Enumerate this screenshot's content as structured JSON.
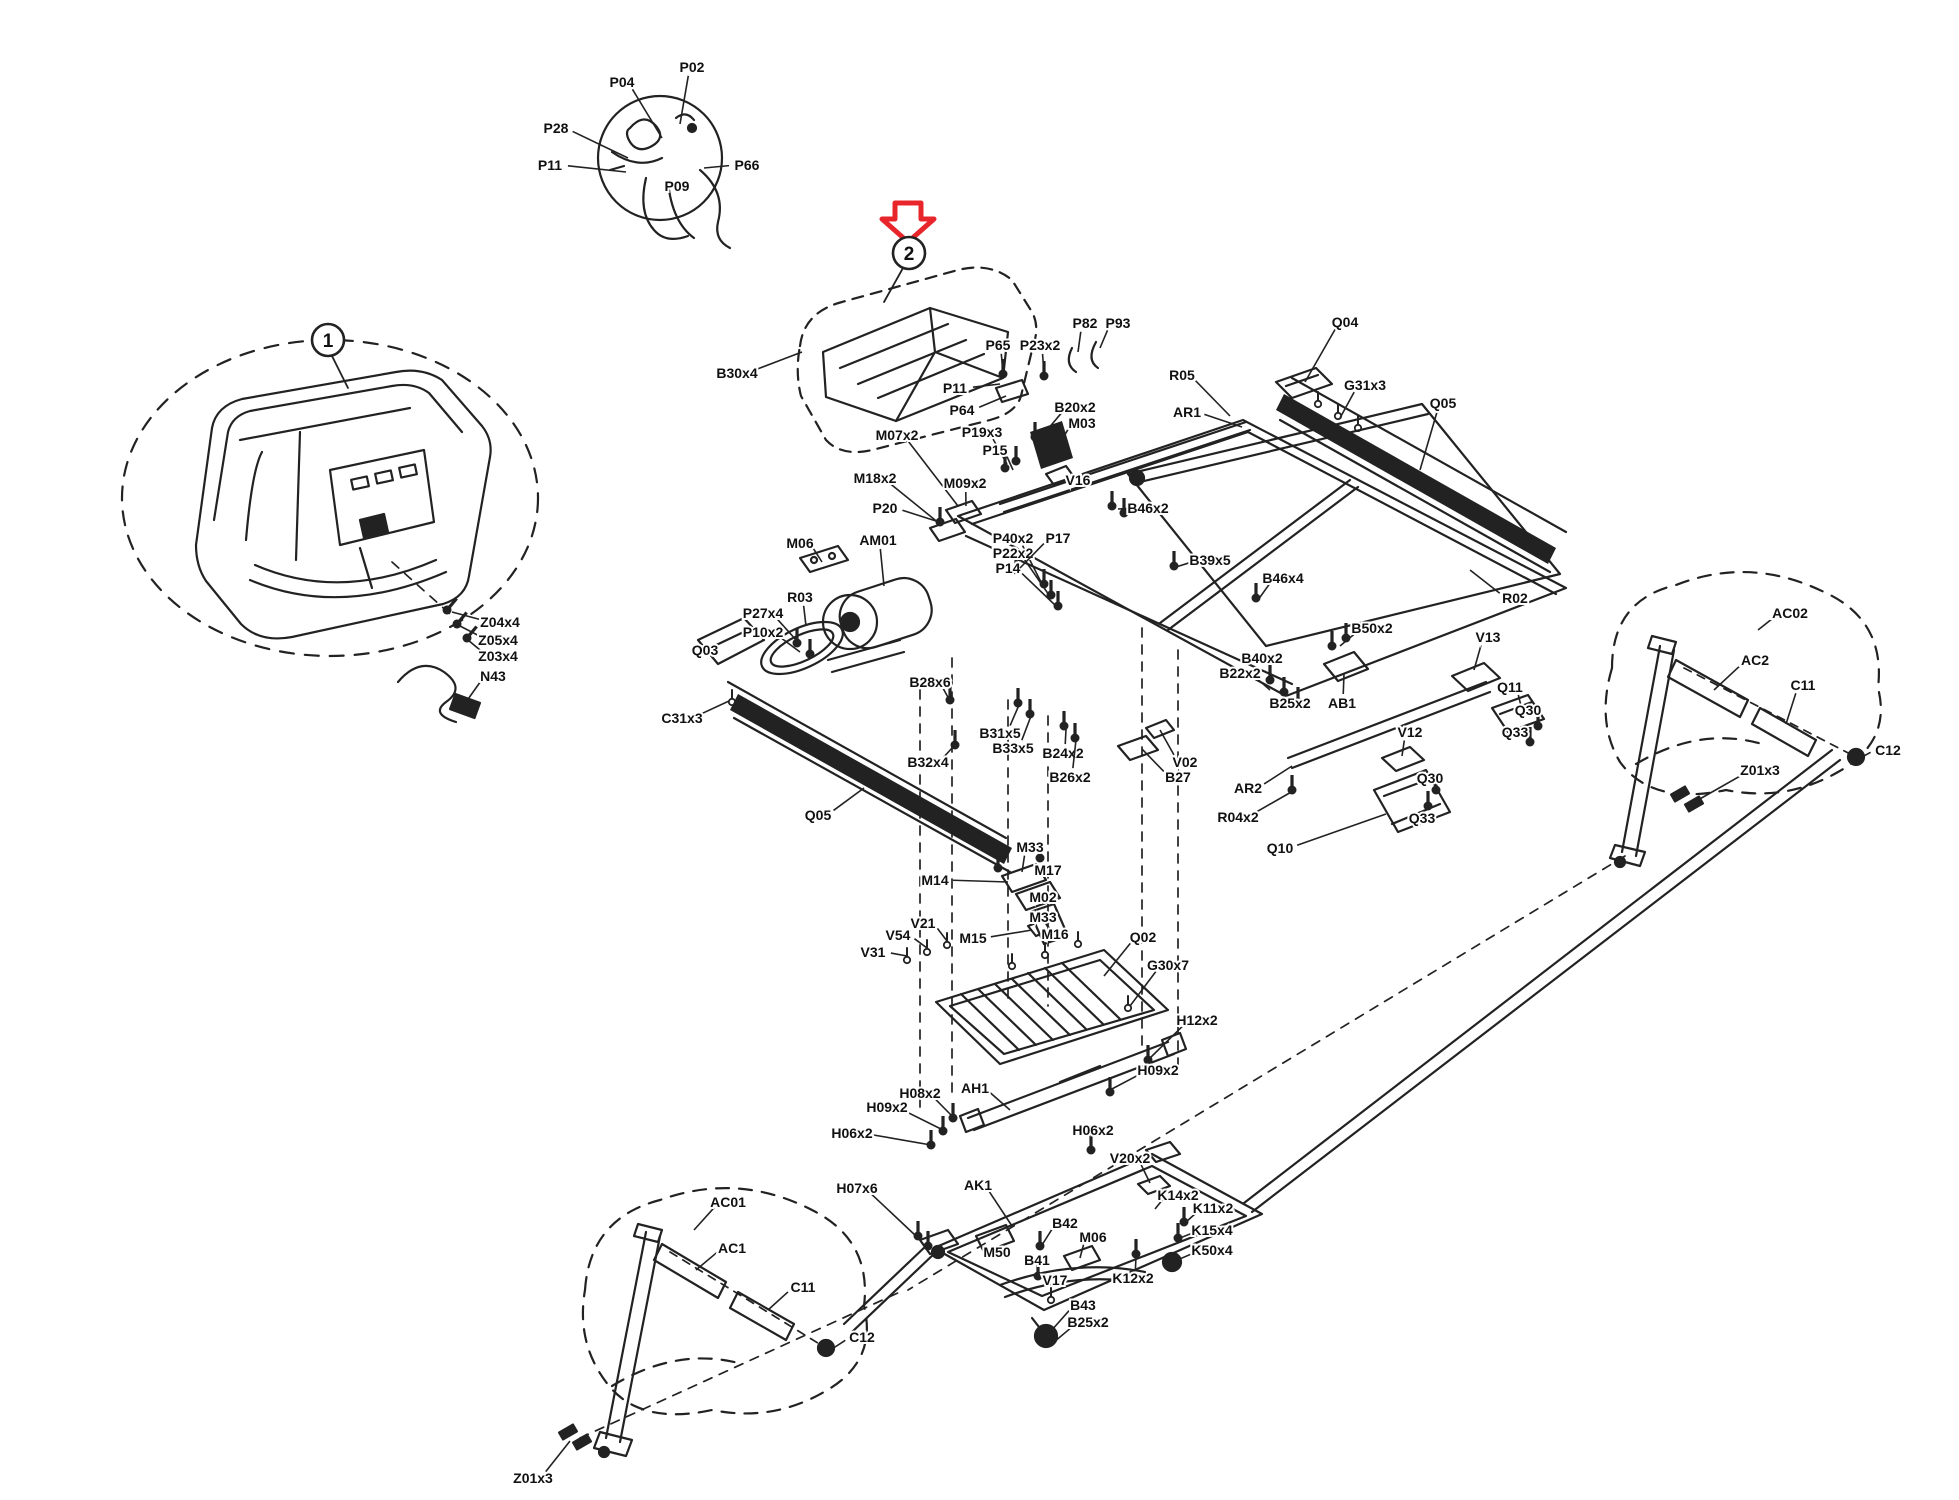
{
  "diagram": {
    "type": "exploded-parts-diagram",
    "arrow_color": "#e8252a",
    "line_color": "#222222",
    "callouts": [
      {
        "n": "1",
        "x": 328,
        "y": 340
      },
      {
        "n": "2",
        "x": 909,
        "y": 253
      }
    ],
    "labels": [
      {
        "t": "P04",
        "x": 622,
        "y": 82,
        "tx": 662,
        "ty": 138
      },
      {
        "t": "P02",
        "x": 692,
        "y": 67,
        "tx": 680,
        "ty": 124
      },
      {
        "t": "P28",
        "x": 556,
        "y": 128,
        "tx": 628,
        "ty": 158
      },
      {
        "t": "P11",
        "x": 550,
        "y": 165,
        "tx": 626,
        "ty": 172
      },
      {
        "t": "P66",
        "x": 747,
        "y": 165,
        "tx": 704,
        "ty": 168
      },
      {
        "t": "P09",
        "x": 677,
        "y": 186,
        "tx": 668,
        "ty": 170
      },
      {
        "t": "B30x4",
        "x": 737,
        "y": 373,
        "tx": 802,
        "ty": 352
      },
      {
        "t": "P65",
        "x": 998,
        "y": 345,
        "tx": 1003,
        "ty": 372
      },
      {
        "t": "P23x2",
        "x": 1040,
        "y": 345,
        "tx": 1044,
        "ty": 373
      },
      {
        "t": "P82",
        "x": 1085,
        "y": 323,
        "tx": 1078,
        "ty": 352
      },
      {
        "t": "P93",
        "x": 1118,
        "y": 323,
        "tx": 1100,
        "ty": 348
      },
      {
        "t": "P11",
        "x": 955,
        "y": 388,
        "tx": 1000,
        "ty": 384
      },
      {
        "t": "P64",
        "x": 962,
        "y": 410,
        "tx": 1006,
        "ty": 396
      },
      {
        "t": "B20x2",
        "x": 1075,
        "y": 407,
        "tx": 1042,
        "ty": 436
      },
      {
        "t": "M03",
        "x": 1082,
        "y": 423,
        "tx": 1062,
        "ty": 440
      },
      {
        "t": "P19x3",
        "x": 982,
        "y": 432,
        "tx": 1007,
        "ty": 464
      },
      {
        "t": "P15",
        "x": 995,
        "y": 450,
        "tx": 1013,
        "ty": 470
      },
      {
        "t": "V16",
        "x": 1078,
        "y": 480,
        "tx": 1058,
        "ty": 476
      },
      {
        "t": "M07x2",
        "x": 897,
        "y": 435,
        "tx": 958,
        "ty": 506
      },
      {
        "t": "M18x2",
        "x": 875,
        "y": 478,
        "tx": 940,
        "ty": 524
      },
      {
        "t": "M09x2",
        "x": 965,
        "y": 483,
        "tx": 966,
        "ty": 506
      },
      {
        "t": "P20",
        "x": 885,
        "y": 508,
        "tx": 936,
        "ty": 521
      },
      {
        "t": "M06",
        "x": 800,
        "y": 543,
        "tx": 822,
        "ty": 562
      },
      {
        "t": "AM01",
        "x": 878,
        "y": 540,
        "tx": 884,
        "ty": 586
      },
      {
        "t": "P40x2",
        "x": 1013,
        "y": 538,
        "tx": 1042,
        "ty": 584
      },
      {
        "t": "P22x2",
        "x": 1013,
        "y": 553,
        "tx": 1049,
        "ty": 595
      },
      {
        "t": "P14",
        "x": 1008,
        "y": 568,
        "tx": 1056,
        "ty": 606
      },
      {
        "t": "P17",
        "x": 1058,
        "y": 538,
        "tx": 1020,
        "ty": 568
      },
      {
        "t": "B46x2",
        "x": 1148,
        "y": 508,
        "tx": 1118,
        "ty": 509
      },
      {
        "t": "B39x5",
        "x": 1210,
        "y": 560,
        "tx": 1176,
        "ty": 567
      },
      {
        "t": "B46x4",
        "x": 1283,
        "y": 578,
        "tx": 1258,
        "ty": 600
      },
      {
        "t": "R03",
        "x": 800,
        "y": 597,
        "tx": 806,
        "ty": 626
      },
      {
        "t": "P27x4",
        "x": 763,
        "y": 613,
        "tx": 797,
        "ty": 641
      },
      {
        "t": "P10x2",
        "x": 763,
        "y": 632,
        "tx": 800,
        "ty": 652
      },
      {
        "t": "Q03",
        "x": 705,
        "y": 650,
        "tx": 724,
        "ty": 649
      },
      {
        "t": "C31x3",
        "x": 682,
        "y": 718,
        "tx": 729,
        "ty": 701
      },
      {
        "t": "Q05",
        "x": 818,
        "y": 815,
        "tx": 864,
        "ty": 788
      },
      {
        "t": "B28x6",
        "x": 930,
        "y": 682,
        "tx": 950,
        "ty": 701
      },
      {
        "t": "B32x4",
        "x": 928,
        "y": 762,
        "tx": 953,
        "ty": 747
      },
      {
        "t": "B31x5",
        "x": 1000,
        "y": 733,
        "tx": 1019,
        "ty": 705
      },
      {
        "t": "B33x5",
        "x": 1013,
        "y": 748,
        "tx": 1031,
        "ty": 716
      },
      {
        "t": "B24x2",
        "x": 1063,
        "y": 753,
        "tx": 1066,
        "ty": 729
      },
      {
        "t": "B26x2",
        "x": 1070,
        "y": 777,
        "tx": 1076,
        "ty": 740
      },
      {
        "t": "V02",
        "x": 1185,
        "y": 762,
        "tx": 1160,
        "ty": 730
      },
      {
        "t": "B27",
        "x": 1178,
        "y": 777,
        "tx": 1142,
        "ty": 749
      },
      {
        "t": "Q04",
        "x": 1345,
        "y": 322,
        "tx": 1305,
        "ty": 382
      },
      {
        "t": "R05",
        "x": 1182,
        "y": 375,
        "tx": 1230,
        "ty": 416
      },
      {
        "t": "AR1",
        "x": 1187,
        "y": 412,
        "tx": 1242,
        "ty": 427
      },
      {
        "t": "G31x3",
        "x": 1365,
        "y": 385,
        "tx": 1340,
        "ty": 418
      },
      {
        "t": "Q05",
        "x": 1443,
        "y": 403,
        "tx": 1420,
        "ty": 470
      },
      {
        "t": "R02",
        "x": 1515,
        "y": 598,
        "tx": 1470,
        "ty": 570
      },
      {
        "t": "V13",
        "x": 1488,
        "y": 637,
        "tx": 1474,
        "ty": 670
      },
      {
        "t": "B50x2",
        "x": 1372,
        "y": 628,
        "tx": 1340,
        "ty": 646
      },
      {
        "t": "B40x2",
        "x": 1262,
        "y": 658,
        "tx": 1272,
        "ty": 680
      },
      {
        "t": "B22x2",
        "x": 1240,
        "y": 673,
        "tx": 1270,
        "ty": 690
      },
      {
        "t": "B25x2",
        "x": 1290,
        "y": 703,
        "tx": 1292,
        "ty": 696
      },
      {
        "t": "AB1",
        "x": 1342,
        "y": 703,
        "tx": 1344,
        "ty": 674
      },
      {
        "t": "Q11",
        "x": 1510,
        "y": 687,
        "tx": 1522,
        "ty": 710
      },
      {
        "t": "Q30",
        "x": 1528,
        "y": 710,
        "tx": 1540,
        "ty": 727
      },
      {
        "t": "Q33",
        "x": 1515,
        "y": 732,
        "tx": 1533,
        "ty": 743
      },
      {
        "t": "V12",
        "x": 1410,
        "y": 732,
        "tx": 1402,
        "ty": 756
      },
      {
        "t": "AR2",
        "x": 1248,
        "y": 788,
        "tx": 1292,
        "ty": 766
      },
      {
        "t": "R04x2",
        "x": 1238,
        "y": 817,
        "tx": 1293,
        "ty": 791
      },
      {
        "t": "Q30",
        "x": 1430,
        "y": 778,
        "tx": 1437,
        "ty": 791
      },
      {
        "t": "Q33",
        "x": 1422,
        "y": 818,
        "tx": 1429,
        "ty": 806
      },
      {
        "t": "Q10",
        "x": 1280,
        "y": 848,
        "tx": 1386,
        "ty": 814
      },
      {
        "t": "AC02",
        "x": 1790,
        "y": 613,
        "tx": 1758,
        "ty": 630
      },
      {
        "t": "AC2",
        "x": 1755,
        "y": 660,
        "tx": 1714,
        "ty": 690
      },
      {
        "t": "C11",
        "x": 1803,
        "y": 685,
        "tx": 1786,
        "ty": 724
      },
      {
        "t": "C12",
        "x": 1888,
        "y": 750,
        "tx": 1862,
        "ty": 757
      },
      {
        "t": "Z01x3",
        "x": 1760,
        "y": 770,
        "tx": 1698,
        "ty": 800
      },
      {
        "t": "M33",
        "x": 1030,
        "y": 847,
        "tx": 1022,
        "ty": 872
      },
      {
        "t": "M17",
        "x": 1048,
        "y": 870,
        "tx": 1036,
        "ty": 884
      },
      {
        "t": "M14",
        "x": 935,
        "y": 880,
        "tx": 1008,
        "ty": 882
      },
      {
        "t": "M02",
        "x": 1043,
        "y": 897,
        "tx": 1048,
        "ty": 906
      },
      {
        "t": "M33",
        "x": 1043,
        "y": 917,
        "tx": 1050,
        "ty": 920
      },
      {
        "t": "M16",
        "x": 1055,
        "y": 934,
        "tx": 1046,
        "ty": 930
      },
      {
        "t": "M15",
        "x": 973,
        "y": 938,
        "tx": 1032,
        "ty": 930
      },
      {
        "t": "V21",
        "x": 923,
        "y": 923,
        "tx": 947,
        "ty": 941
      },
      {
        "t": "V54",
        "x": 898,
        "y": 935,
        "tx": 927,
        "ty": 948
      },
      {
        "t": "V31",
        "x": 873,
        "y": 952,
        "tx": 907,
        "ty": 956
      },
      {
        "t": "Q02",
        "x": 1143,
        "y": 937,
        "tx": 1104,
        "ty": 976
      },
      {
        "t": "G30x7",
        "x": 1168,
        "y": 965,
        "tx": 1130,
        "ty": 1006
      },
      {
        "t": "H12x2",
        "x": 1197,
        "y": 1020,
        "tx": 1148,
        "ty": 1060
      },
      {
        "t": "H09x2",
        "x": 1158,
        "y": 1070,
        "tx": 1110,
        "ty": 1090
      },
      {
        "t": "AH1",
        "x": 975,
        "y": 1088,
        "tx": 1010,
        "ty": 1110
      },
      {
        "t": "H08x2",
        "x": 920,
        "y": 1093,
        "tx": 953,
        "ty": 1117
      },
      {
        "t": "H09x2",
        "x": 887,
        "y": 1107,
        "tx": 943,
        "ty": 1130
      },
      {
        "t": "H06x2",
        "x": 852,
        "y": 1133,
        "tx": 931,
        "ty": 1145
      },
      {
        "t": "H06x2",
        "x": 1093,
        "y": 1130,
        "tx": 1091,
        "ty": 1149
      },
      {
        "t": "V20x2",
        "x": 1130,
        "y": 1158,
        "tx": 1150,
        "ty": 1183
      },
      {
        "t": "H07x6",
        "x": 857,
        "y": 1188,
        "tx": 916,
        "ty": 1236
      },
      {
        "t": "AK1",
        "x": 978,
        "y": 1185,
        "tx": 1012,
        "ty": 1226
      },
      {
        "t": "B42",
        "x": 1065,
        "y": 1223,
        "tx": 1042,
        "ty": 1245
      },
      {
        "t": "M06",
        "x": 1093,
        "y": 1237,
        "tx": 1080,
        "ty": 1258
      },
      {
        "t": "M50",
        "x": 997,
        "y": 1252,
        "tx": 990,
        "ty": 1240
      },
      {
        "t": "B41",
        "x": 1037,
        "y": 1260,
        "tx": 1039,
        "ty": 1276
      },
      {
        "t": "V17",
        "x": 1055,
        "y": 1280,
        "tx": 1051,
        "ty": 1298
      },
      {
        "t": "K14x2",
        "x": 1178,
        "y": 1195,
        "tx": 1155,
        "ty": 1209
      },
      {
        "t": "K11x2",
        "x": 1213,
        "y": 1208,
        "tx": 1186,
        "ty": 1222
      },
      {
        "t": "K15x4",
        "x": 1212,
        "y": 1230,
        "tx": 1180,
        "ty": 1238
      },
      {
        "t": "K50x4",
        "x": 1212,
        "y": 1250,
        "tx": 1175,
        "ty": 1261
      },
      {
        "t": "K12x2",
        "x": 1133,
        "y": 1278,
        "tx": 1136,
        "ty": 1256
      },
      {
        "t": "B43",
        "x": 1083,
        "y": 1305,
        "tx": 1051,
        "ty": 1331
      },
      {
        "t": "B25x2",
        "x": 1088,
        "y": 1322,
        "tx": 1054,
        "ty": 1342
      },
      {
        "t": "AC01",
        "x": 728,
        "y": 1202,
        "tx": 694,
        "ty": 1230
      },
      {
        "t": "AC1",
        "x": 732,
        "y": 1248,
        "tx": 696,
        "ty": 1270
      },
      {
        "t": "C11",
        "x": 803,
        "y": 1287,
        "tx": 768,
        "ty": 1310
      },
      {
        "t": "C12",
        "x": 862,
        "y": 1337,
        "tx": 832,
        "ty": 1349
      },
      {
        "t": "Z01x3",
        "x": 533,
        "y": 1478,
        "tx": 570,
        "ty": 1441
      },
      {
        "t": "Z04x4",
        "x": 500,
        "y": 622,
        "tx": 452,
        "ty": 612
      },
      {
        "t": "Z05x4",
        "x": 498,
        "y": 640,
        "tx": 460,
        "ty": 626
      },
      {
        "t": "Z03x4",
        "x": 498,
        "y": 656,
        "tx": 468,
        "ty": 640
      },
      {
        "t": "N43",
        "x": 493,
        "y": 676,
        "tx": 466,
        "ty": 702
      }
    ]
  }
}
